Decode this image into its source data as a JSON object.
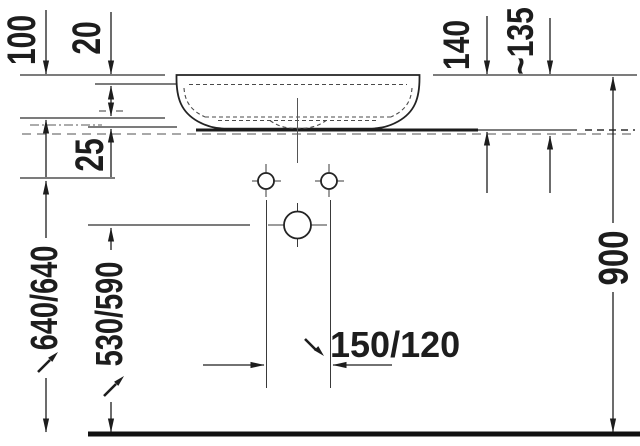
{
  "drawing": {
    "kind": "washbasin-installation-technical-drawing",
    "dimensions": {
      "basin_inner_depth": "100",
      "rim_ledge": "20",
      "basin_total_height": "140",
      "surface_offset": "~135",
      "countertop_thickness": "25",
      "console_height": "640/640",
      "drain_height": "530/590",
      "tap_hole_spacing": "150/120",
      "top_edge_height": "900"
    },
    "colors": {
      "line": "#1d1d1d",
      "secondary_dashed": "#8c8c8c",
      "background": "#ffffff"
    }
  }
}
